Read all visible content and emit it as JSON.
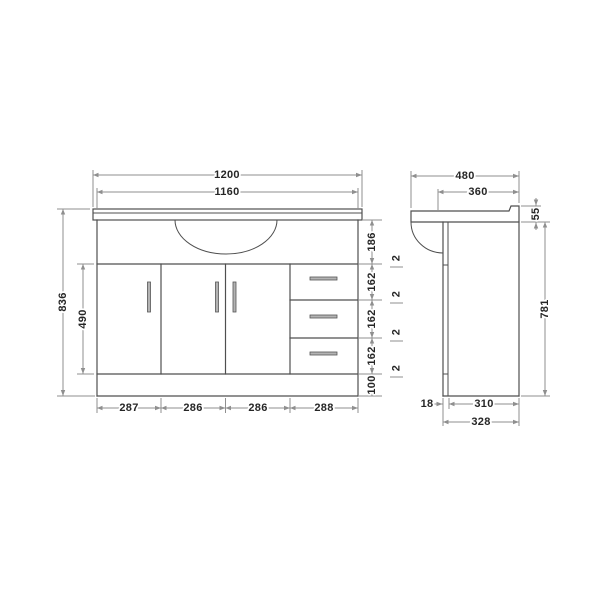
{
  "drawing": {
    "front": {
      "width_total": "1200",
      "width_top": "1160",
      "height_total": "836",
      "height_doors": "490",
      "right_chain": [
        "186",
        "2",
        "162",
        "2",
        "162",
        "2",
        "162",
        "2",
        "100"
      ],
      "bottom_segments": [
        "287",
        "286",
        "286",
        "288"
      ]
    },
    "side": {
      "depth_total": "480",
      "depth_top": "360",
      "upstand_height": "55",
      "height_cabinet": "781",
      "door_thickness": "18",
      "depth_body": "310",
      "depth_base": "328"
    },
    "colors": {
      "outline": "#4f4f4f",
      "dimension_line": "#8f8f8f",
      "handle_fill": "#b3b3b3",
      "background": "#ffffff"
    }
  }
}
